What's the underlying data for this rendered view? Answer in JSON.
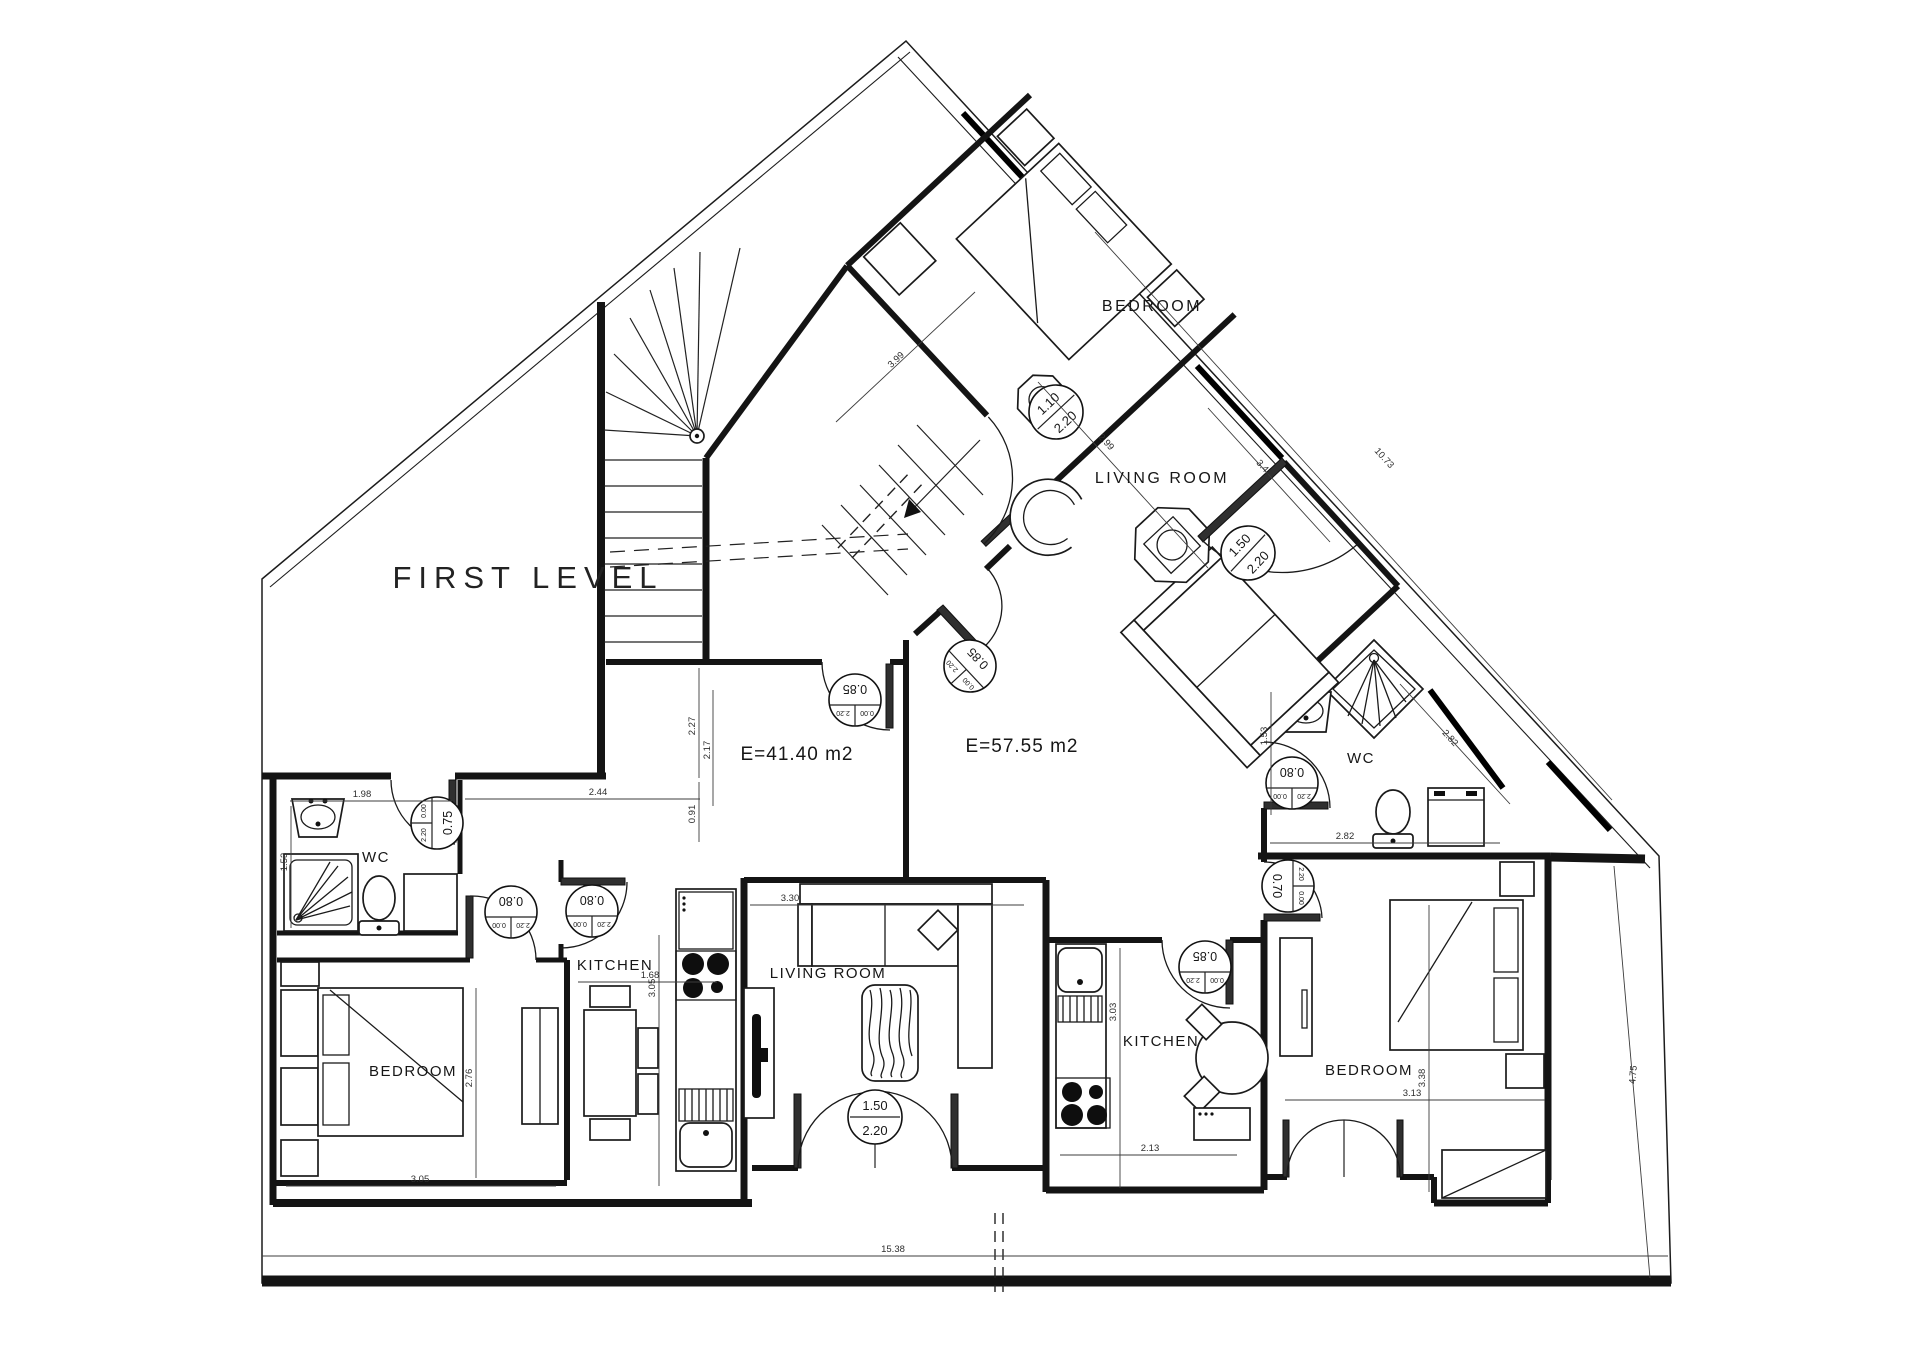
{
  "title": "FIRST LEVEL",
  "areas": {
    "apartment_a": "E=41.40 m2",
    "apartment_b": "E=57.55 m2"
  },
  "rooms": {
    "bedroom_top": "BEDROOM",
    "living_top": "LIVING ROOM",
    "wc_right": "WC",
    "kitchen_right": "KITCHEN",
    "bedroom_right": "BEDROOM",
    "bedroom_left": "BEDROOM",
    "wc_left": "WC",
    "kitchen_left": "KITCHEN",
    "living_bottom": "LIVING ROOM"
  },
  "door_tags": [
    {
      "w": "1.10",
      "h": "2.20"
    },
    {
      "w": "0.75",
      "h": "2.20",
      "sill": "0.00"
    },
    {
      "w": "0.80",
      "h": "2.20",
      "sill": "0.00"
    },
    {
      "w": "0.80",
      "h": "2.20",
      "sill": "0.00"
    },
    {
      "w": "0.85",
      "h": "2.20",
      "sill": "0.00"
    },
    {
      "w": "0.85",
      "h": "2.20",
      "sill": "0.00"
    },
    {
      "w": "1.50",
      "h": "2.20"
    },
    {
      "w": "1.50",
      "h": "2.20"
    },
    {
      "w": "0.80",
      "h": "2.20",
      "sill": "0.00"
    },
    {
      "w": "0.85",
      "h": "2.20",
      "sill": "0.00"
    },
    {
      "w": "0.70",
      "h": "2.20",
      "sill": "0.00"
    }
  ],
  "dimensions": [
    "1.98",
    "2.44",
    "1.53",
    "2.76",
    "3.05",
    "1.68",
    "3.05",
    "3.30",
    "3.03",
    "2.13",
    "2.82",
    "1.53",
    "3.38",
    "3.13",
    "15.38",
    "4.75",
    "10.73",
    "3.99",
    "2.99",
    "3.41",
    "2.82",
    "2.27",
    "2.17",
    "0.91"
  ],
  "colors": {
    "ink": "#141414",
    "background": "#ffffff"
  }
}
